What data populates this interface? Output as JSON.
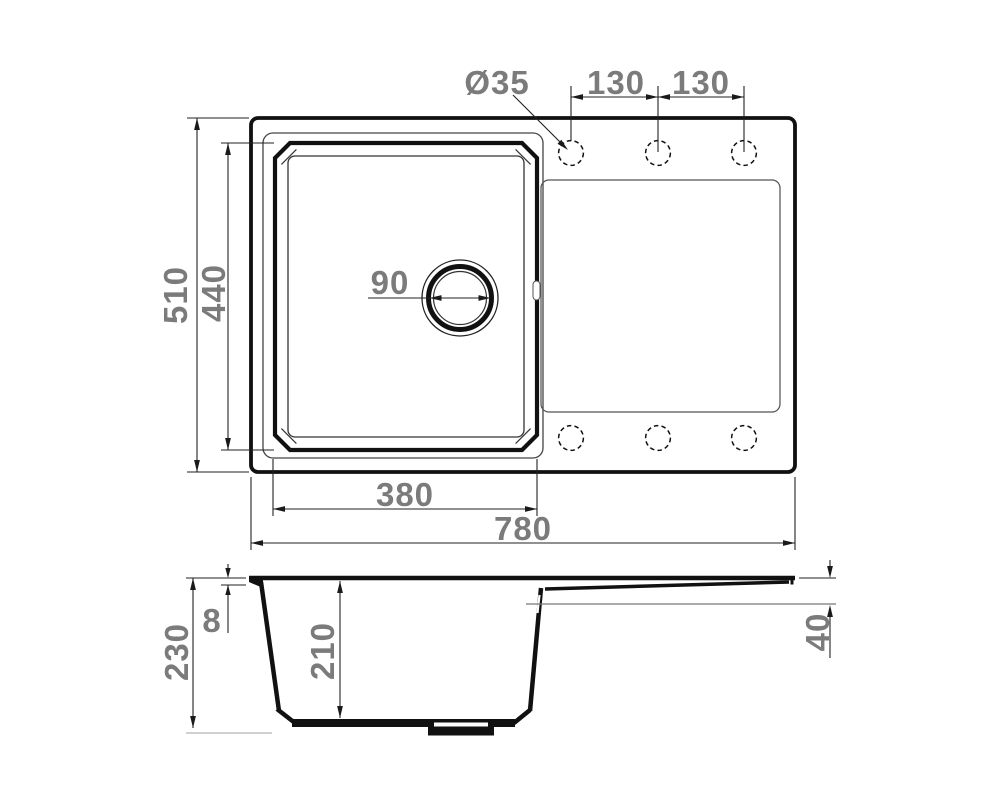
{
  "drawing": {
    "type": "technical-drawing",
    "subject": "kitchen sink with bowl and drainboard — plan view and section view",
    "units": "mm",
    "colors": {
      "line": "#111111",
      "dimension_text": "#7b7b7b",
      "background": "#ffffff",
      "light_extension_line": "#b3b3b3"
    },
    "dimensions": {
      "tap_hole_diameter": "Ø35",
      "tap_spacing_1": "130",
      "tap_spacing_2": "130",
      "overall_depth": "510",
      "bowl_inner_depth": "440",
      "drain_diameter": "90",
      "bowl_inner_width": "380",
      "overall_width": "780",
      "overall_height": "230",
      "rim_thickness": "8",
      "bowl_depth": "210",
      "drainboard_drop": "40"
    }
  }
}
